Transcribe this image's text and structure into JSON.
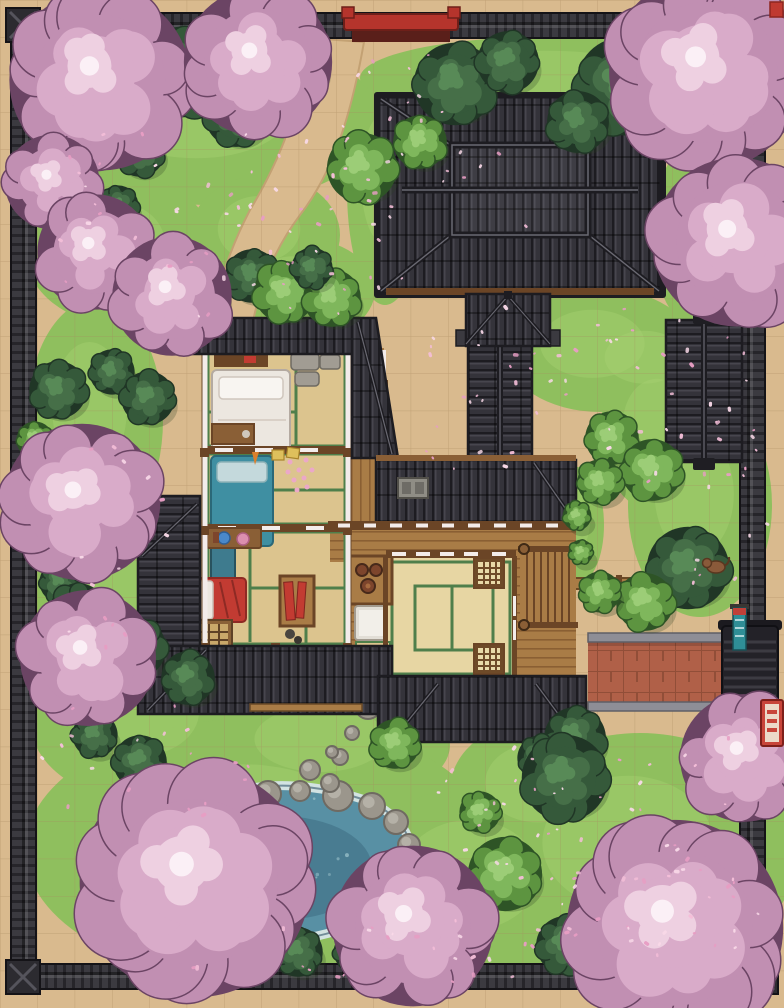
{
  "scene": {
    "kind": "top-down battle map, japanese sakura estate",
    "grid": {
      "cols": 21,
      "rows": 27,
      "cell_px": 37.333
    }
  },
  "colors": {
    "ground": "#d9ba8e",
    "ground_line": "#a8875d",
    "grass": "#8fbf5e",
    "grass_light": "#a6d170",
    "grass_dark": "#6f9e45",
    "wall_dark": "#26252a",
    "wall_mid": "#3b3a40",
    "wall_light": "#55545c",
    "roof": "#34333a",
    "roof_rib": "#47464e",
    "roof_dark": "#1d1c21",
    "roof_ridge": "#6a6972",
    "wood": "#a97c46",
    "wood_dark": "#6b4526",
    "wood_beam": "#8a5f36",
    "tatami": "#dcc48e",
    "tatami_light": "#e7d6a3",
    "tatami_green": "#4f7f4b",
    "shoji": "#f3ecea",
    "futon_white": "#ece7e0",
    "futon_teal": "#3f8fa2",
    "futon_red": "#c23b32",
    "water": "#5890a4",
    "water_deep": "#47798e",
    "water_light": "#9cc3cb",
    "foam": "#d3e3e2",
    "rock": "#9b968c",
    "rock_dark": "#6f6a62",
    "rock_light": "#bab6ac",
    "cherry_outline": "#6b4464",
    "cherry_base": "#c18fb2",
    "cherry_mid": "#d9abc9",
    "cherry_light": "#eed0e1",
    "cherry_core": "#fbf0f6",
    "leaf_outline": "#203626",
    "leaf_dark": "#35593a",
    "leaf_dark2": "#466f48",
    "leaf_light": "#5d9440",
    "leaf_light2": "#7fb75c",
    "stone_path": "#b06048",
    "stone_line": "#8a4a34",
    "curb": "#8e8e96",
    "red_sign": "#b5342c",
    "banner_teal": "#2f8e96",
    "petal_palette": [
      "#f4bed8",
      "#e79dc3",
      "#f9d9e8"
    ]
  },
  "grass_patches": [
    [
      210,
      120,
      170,
      85
    ],
    [
      120,
      250,
      95,
      75
    ],
    [
      265,
      235,
      75,
      60
    ],
    [
      300,
      290,
      75,
      52
    ],
    [
      560,
      78,
      200,
      42
    ],
    [
      385,
      190,
      38,
      115
    ],
    [
      95,
      420,
      68,
      120
    ],
    [
      112,
      600,
      85,
      125
    ],
    [
      145,
      720,
      115,
      82
    ],
    [
      330,
      745,
      120,
      60
    ],
    [
      600,
      350,
      95,
      62
    ],
    [
      650,
      362,
      72,
      48
    ],
    [
      662,
      432,
      62,
      82
    ],
    [
      700,
      505,
      72,
      112
    ],
    [
      578,
      525,
      26,
      58
    ],
    [
      700,
      235,
      48,
      95
    ],
    [
      260,
      850,
      235,
      132
    ],
    [
      480,
      885,
      125,
      100
    ],
    [
      640,
      855,
      155,
      122
    ],
    [
      545,
      790,
      95,
      72
    ]
  ],
  "cherry_trees": [
    {
      "x": 100,
      "y": 80,
      "r": 88
    },
    {
      "x": 258,
      "y": 62,
      "r": 72
    },
    {
      "x": 52,
      "y": 182,
      "r": 46
    },
    {
      "x": 95,
      "y": 252,
      "r": 56
    },
    {
      "x": 172,
      "y": 296,
      "r": 58
    },
    {
      "x": 707,
      "y": 72,
      "r": 95
    },
    {
      "x": 737,
      "y": 242,
      "r": 82
    },
    {
      "x": 82,
      "y": 502,
      "r": 76
    },
    {
      "x": 88,
      "y": 658,
      "r": 66
    },
    {
      "x": 195,
      "y": 882,
      "r": 112
    },
    {
      "x": 413,
      "y": 926,
      "r": 78
    },
    {
      "x": 744,
      "y": 758,
      "r": 62
    },
    {
      "x": 675,
      "y": 928,
      "r": 105
    }
  ],
  "green_plants": [
    {
      "x": 182,
      "y": 72,
      "r": 44,
      "tone": "dark"
    },
    {
      "x": 236,
      "y": 116,
      "r": 30,
      "tone": "dark"
    },
    {
      "x": 140,
      "y": 152,
      "r": 24,
      "tone": "dark"
    },
    {
      "x": 118,
      "y": 206,
      "r": 20,
      "tone": "dark"
    },
    {
      "x": 455,
      "y": 84,
      "r": 40,
      "tone": "dark"
    },
    {
      "x": 508,
      "y": 62,
      "r": 30,
      "tone": "dark"
    },
    {
      "x": 625,
      "y": 86,
      "r": 48,
      "tone": "dark"
    },
    {
      "x": 578,
      "y": 122,
      "r": 30,
      "tone": "dark"
    },
    {
      "x": 686,
      "y": 110,
      "r": 26,
      "tone": "dark"
    },
    {
      "x": 420,
      "y": 142,
      "r": 26,
      "tone": "light"
    },
    {
      "x": 362,
      "y": 168,
      "r": 34,
      "tone": "light"
    },
    {
      "x": 252,
      "y": 276,
      "r": 26,
      "tone": "dark"
    },
    {
      "x": 285,
      "y": 292,
      "r": 30,
      "tone": "light"
    },
    {
      "x": 332,
      "y": 298,
      "r": 28,
      "tone": "light"
    },
    {
      "x": 312,
      "y": 268,
      "r": 20,
      "tone": "dark"
    },
    {
      "x": 58,
      "y": 390,
      "r": 28,
      "tone": "dark"
    },
    {
      "x": 112,
      "y": 372,
      "r": 22,
      "tone": "dark"
    },
    {
      "x": 148,
      "y": 398,
      "r": 26,
      "tone": "dark"
    },
    {
      "x": 35,
      "y": 440,
      "r": 18,
      "tone": "light"
    },
    {
      "x": 60,
      "y": 582,
      "r": 20,
      "tone": "dark"
    },
    {
      "x": 78,
      "y": 612,
      "r": 28,
      "tone": "dark"
    },
    {
      "x": 135,
      "y": 648,
      "r": 30,
      "tone": "dark"
    },
    {
      "x": 188,
      "y": 678,
      "r": 26,
      "tone": "dark"
    },
    {
      "x": 95,
      "y": 735,
      "r": 22,
      "tone": "dark"
    },
    {
      "x": 140,
      "y": 762,
      "r": 26,
      "tone": "dark"
    },
    {
      "x": 612,
      "y": 438,
      "r": 26,
      "tone": "light"
    },
    {
      "x": 652,
      "y": 470,
      "r": 30,
      "tone": "light"
    },
    {
      "x": 600,
      "y": 482,
      "r": 22,
      "tone": "light"
    },
    {
      "x": 577,
      "y": 516,
      "r": 14,
      "tone": "light"
    },
    {
      "x": 581,
      "y": 552,
      "r": 12,
      "tone": "light"
    },
    {
      "x": 688,
      "y": 568,
      "r": 40,
      "tone": "dark"
    },
    {
      "x": 645,
      "y": 602,
      "r": 28,
      "tone": "light"
    },
    {
      "x": 600,
      "y": 592,
      "r": 20,
      "tone": "light"
    },
    {
      "x": 575,
      "y": 738,
      "r": 30,
      "tone": "dark"
    },
    {
      "x": 540,
      "y": 758,
      "r": 22,
      "tone": "dark"
    },
    {
      "x": 565,
      "y": 778,
      "r": 42,
      "tone": "dark"
    },
    {
      "x": 395,
      "y": 744,
      "r": 24,
      "tone": "light"
    },
    {
      "x": 505,
      "y": 874,
      "r": 36,
      "tone": "light"
    },
    {
      "x": 480,
      "y": 812,
      "r": 20,
      "tone": "light"
    },
    {
      "x": 195,
      "y": 948,
      "r": 22,
      "tone": "dark"
    },
    {
      "x": 245,
      "y": 958,
      "r": 20,
      "tone": "light"
    },
    {
      "x": 298,
      "y": 952,
      "r": 24,
      "tone": "dark"
    },
    {
      "x": 352,
      "y": 952,
      "r": 18,
      "tone": "dark"
    },
    {
      "x": 405,
      "y": 945,
      "r": 20,
      "tone": "dark"
    },
    {
      "x": 448,
      "y": 938,
      "r": 16,
      "tone": "light"
    },
    {
      "x": 565,
      "y": 945,
      "r": 28,
      "tone": "dark"
    },
    {
      "x": 615,
      "y": 928,
      "r": 22,
      "tone": "dark"
    }
  ],
  "pond": {
    "rocks": [
      [
        152,
        832,
        17
      ],
      [
        200,
        810,
        13
      ],
      [
        232,
        799,
        11
      ],
      [
        268,
        794,
        13
      ],
      [
        300,
        791,
        10
      ],
      [
        338,
        796,
        15
      ],
      [
        372,
        806,
        13
      ],
      [
        396,
        822,
        12
      ],
      [
        409,
        845,
        11
      ],
      [
        402,
        872,
        10
      ],
      [
        390,
        928,
        13
      ],
      [
        362,
        945,
        10
      ],
      [
        198,
        928,
        11
      ],
      [
        228,
        941,
        8
      ],
      [
        138,
        862,
        12
      ],
      [
        136,
        890,
        10
      ]
    ]
  },
  "stepping_stones": [
    [
      368,
      706,
      13
    ],
    [
      352,
      733,
      7
    ],
    [
      340,
      757,
      8
    ],
    [
      330,
      783,
      9
    ],
    [
      310,
      770,
      10
    ],
    [
      332,
      752,
      6
    ]
  ],
  "petal_zones": [
    [
      55,
      125,
      270,
      190,
      40
    ],
    [
      330,
      115,
      200,
      110,
      18
    ],
    [
      255,
      185,
      160,
      130,
      16
    ],
    [
      340,
      40,
      120,
      80,
      10
    ],
    [
      420,
      300,
      190,
      170,
      30
    ],
    [
      600,
      300,
      150,
      210,
      24
    ],
    [
      690,
      400,
      80,
      190,
      16
    ],
    [
      60,
      440,
      120,
      220,
      14
    ],
    [
      40,
      690,
      210,
      130,
      18
    ],
    [
      430,
      735,
      310,
      210,
      45
    ],
    [
      195,
      925,
      410,
      55,
      22
    ],
    [
      545,
      835,
      225,
      125,
      26
    ]
  ]
}
